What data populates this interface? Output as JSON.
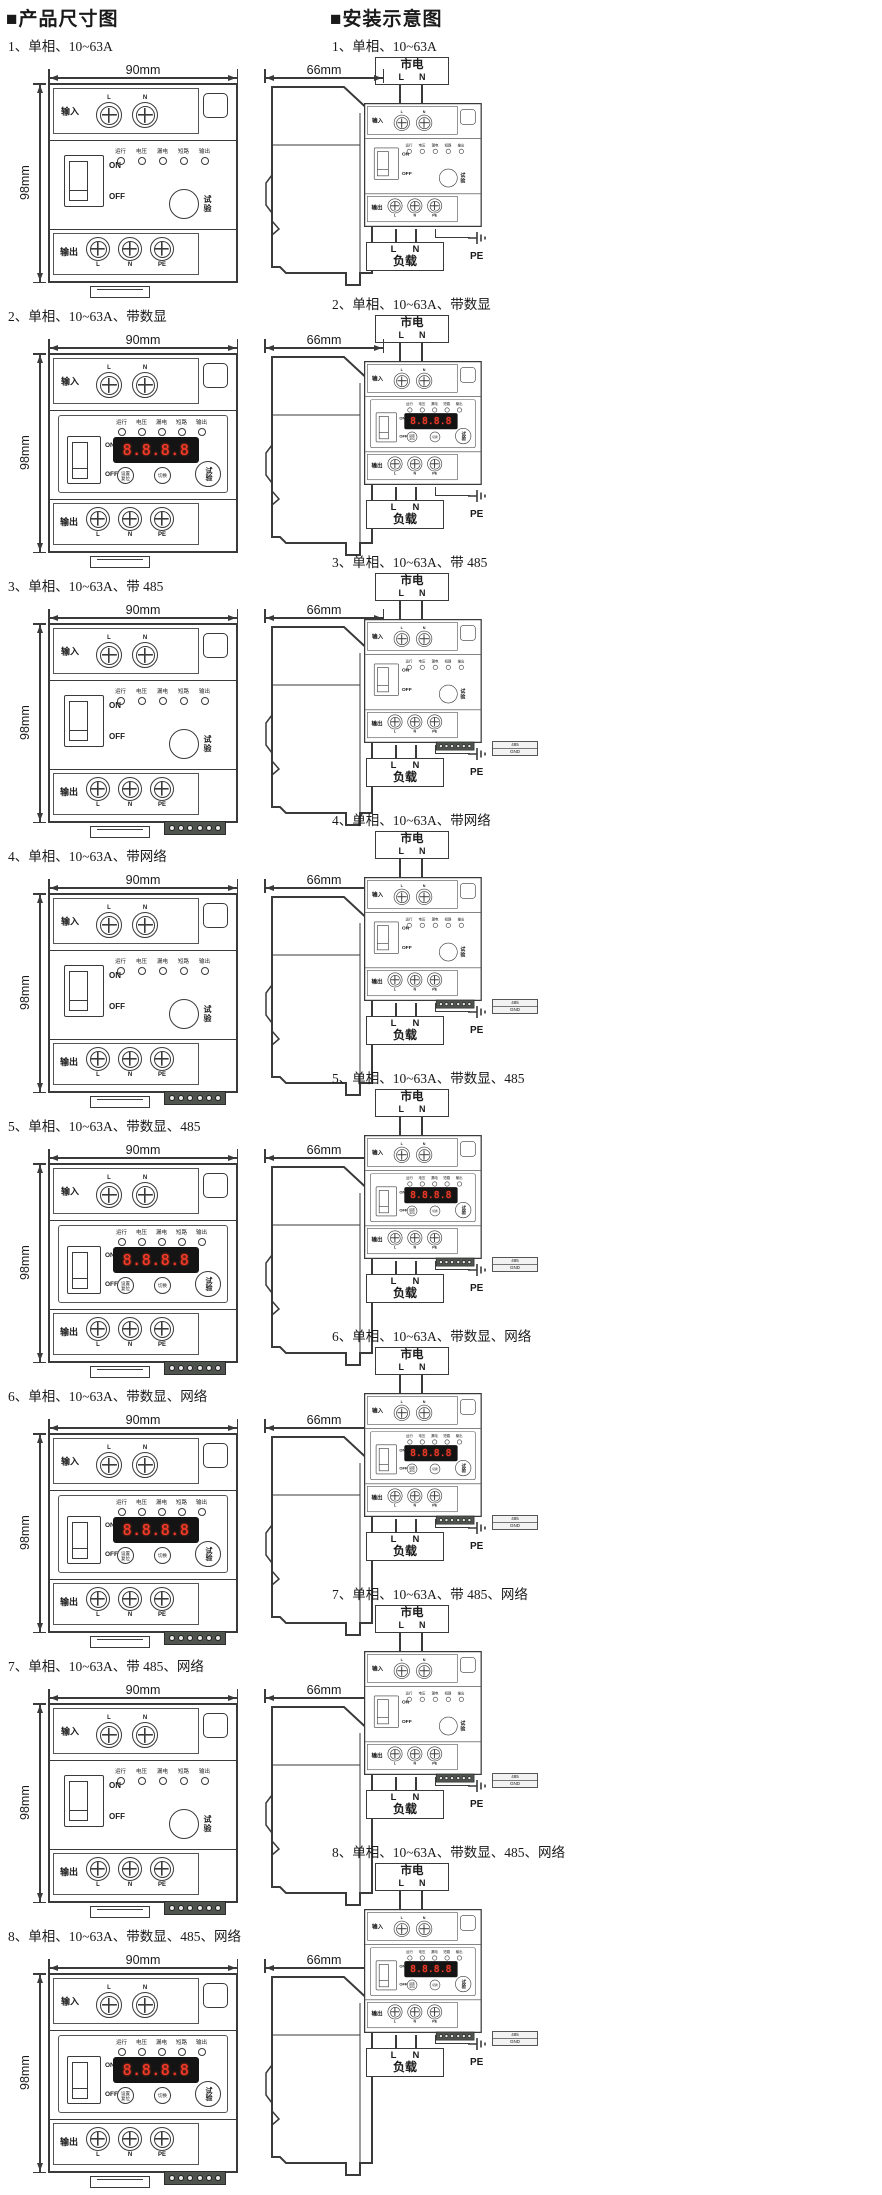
{
  "page": {
    "left_title": "■产品尺寸图",
    "right_title": "■安装示意图"
  },
  "dims": {
    "front_width": "90mm",
    "front_height": "98mm",
    "side_width": "66mm"
  },
  "sections": [
    {
      "num": "1、",
      "name": "单相、10~63A",
      "display": false,
      "comm485": false,
      "network": false
    },
    {
      "num": "2、",
      "name": "单相、10~63A、带数显",
      "display": true,
      "comm485": false,
      "network": false
    },
    {
      "num": "3、",
      "name": "单相、10~63A、带 485",
      "display": false,
      "comm485": true,
      "network": false
    },
    {
      "num": "4、",
      "name": "单相、10~63A、带网络",
      "display": false,
      "comm485": false,
      "network": true
    },
    {
      "num": "5、",
      "name": "单相、10~63A、带数显、485",
      "display": true,
      "comm485": true,
      "network": false
    },
    {
      "num": "6、",
      "name": "单相、10~63A、带数显、网络",
      "display": true,
      "comm485": false,
      "network": true
    },
    {
      "num": "7、",
      "name": "单相、10~63A、带 485、网络",
      "display": false,
      "comm485": true,
      "network": true
    },
    {
      "num": "8、",
      "name": "单相、10~63A、带数显、485、网络",
      "display": true,
      "comm485": true,
      "network": true
    }
  ],
  "device": {
    "input_label": "输入",
    "output_label": "输出",
    "in_terms": [
      "L",
      "N"
    ],
    "out_terms": [
      "L",
      "N",
      "PE"
    ],
    "leds": [
      "运行",
      "电压",
      "漏电",
      "短路",
      "输出"
    ],
    "switch_on": "ON",
    "switch_off": "OFF",
    "test_label": "试验",
    "display_digits": "8.8.8.8",
    "btn_set": "设置",
    "btn_reset": "复位",
    "btn_switch": "切换"
  },
  "install": {
    "mains_label": "市电",
    "mains_terms": [
      "L",
      "N"
    ],
    "load_label": "负载",
    "load_terms": [
      "L",
      "N"
    ],
    "pe_label": "PE",
    "comm_caption_top": "485",
    "comm_caption_bottom": "GND"
  }
}
